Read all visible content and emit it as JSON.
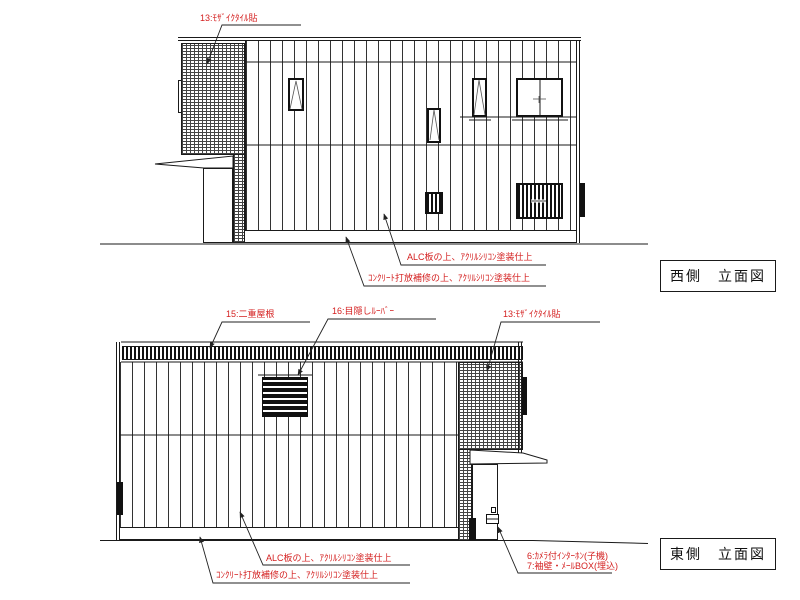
{
  "colors": {
    "annotation_red": "#d42020",
    "line_black": "#1a1a1a"
  },
  "west": {
    "title": "西側　立面図",
    "labels": {
      "tile": "13:ﾓｻﾞｲｸﾀｲﾙ貼",
      "alc": "ALC板の上、ｱｸﾘﾙｼﾘｺﾝ塗装仕上",
      "concrete": "ｺﾝｸﾘｰﾄ打放補修の上、ｱｸﾘﾙｼﾘｺﾝ塗装仕上"
    }
  },
  "east": {
    "title": "東側　立面図",
    "labels": {
      "roof": "15:二重屋根",
      "louver": "16:目隠しﾙｰﾊﾞｰ",
      "tile": "13:ﾓｻﾞｲｸﾀｲﾙ貼",
      "alc": "ALC板の上、ｱｸﾘﾙｼﾘｺﾝ塗装仕上",
      "concrete": "ｺﾝｸﾘｰﾄ打放補修の上、ｱｸﾘﾙｼﾘｺﾝ塗装仕上",
      "intercom": "6:ｶﾒﾗ付ｲﾝﾀｰﾎﾝ(子機)",
      "mailbox": "7:袖壁・ﾒｰﾙBOX(埋込)"
    }
  }
}
